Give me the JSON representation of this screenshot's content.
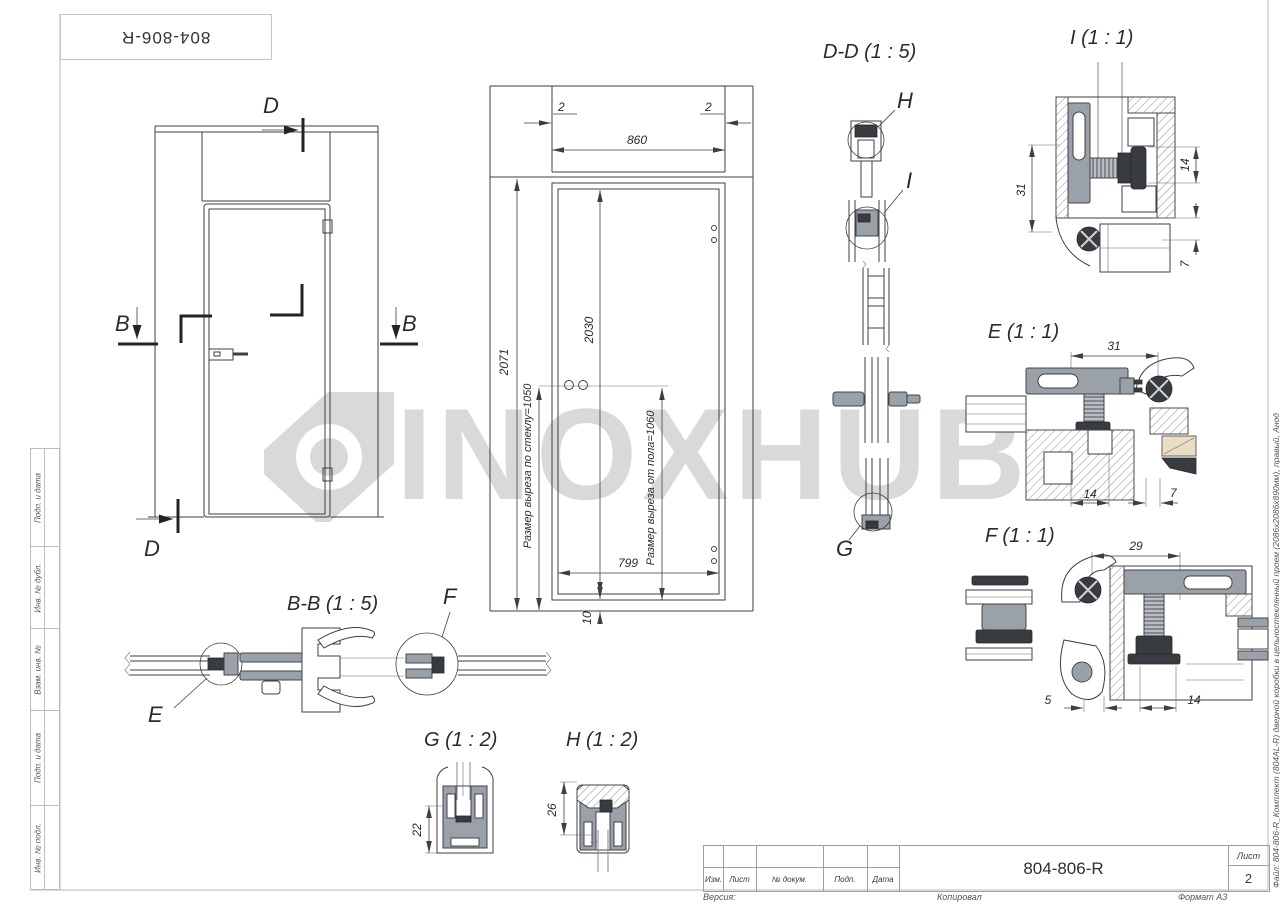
{
  "colors": {
    "line": "#3f3f3f",
    "frame_gray": "#c5c5c5",
    "metal_gray": "#9aa1a9",
    "dark_part": "#383b40",
    "watermark_gray": "#d9d9d9",
    "wood": "#e9ddc6"
  },
  "watermark": {
    "text": "INOXHUB"
  },
  "frame": {
    "side_boxes": [
      "Подп. и дата",
      "Инв. № дубл.",
      "Взам. инв. №",
      "Подп. и дата",
      "Инв. № подл."
    ],
    "file_note": "Файл: 804-806-R_Комплект (804AL-R) дверной коробки в цельностеклянный проем (2086х2086х890мм), правый, Анод"
  },
  "title_block": {
    "drawing_number": "804-806-R",
    "col_izm": "Изм.",
    "col_list": "Лист",
    "col_doc": "№ докум.",
    "col_podp": "Подп.",
    "col_data": "Дата",
    "sheet_label": "Лист",
    "sheet_number": "2",
    "footer_version": "Версия:",
    "footer_copied": "Копировал",
    "footer_format": "Формат A3"
  },
  "views": {
    "front": {
      "d_top": "D",
      "b_left": "B",
      "b_right": "B",
      "d_bottom": "D"
    },
    "dims": {
      "gap_left": "2",
      "gap_right": "2",
      "width": "860",
      "height_total": "2071",
      "height_leaf": "2030",
      "glass_note": "Размер выреза по стеклу=1050",
      "floor_note": "Размер выреза от пола=1060",
      "width_leaf": "799",
      "bottom_gap": "10"
    },
    "section_dd": {
      "title": "D-D (1 : 5)",
      "label_h": "H",
      "label_i": "I",
      "label_g": "G"
    },
    "detail_i": {
      "title": "I (1 : 1)",
      "d1": "31",
      "d2": "14",
      "d3": "7"
    },
    "detail_e": {
      "title": "E (1 : 1)",
      "d1": "31",
      "d2": "14",
      "d3": "7"
    },
    "detail_f": {
      "title": "F (1 : 1)",
      "d1": "29",
      "d2": "5",
      "d3": "14"
    },
    "section_bb": {
      "title": "B-B (1 : 5)",
      "label_e": "E",
      "label_f": "F"
    },
    "detail_g": {
      "title": "G (1 : 2)",
      "d1": "22"
    },
    "detail_h": {
      "title": "H (1 : 2)",
      "d1": "26"
    }
  }
}
